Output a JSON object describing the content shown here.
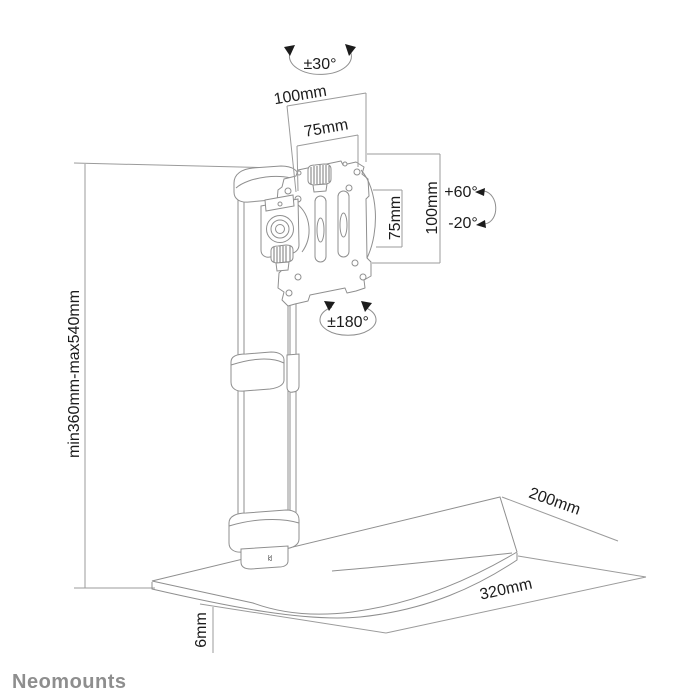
{
  "drawing": {
    "title_hint": "monitor desk stand technical drawing",
    "labels": {
      "swivel_top": "±30°",
      "vesa_width_outer": "100mm",
      "vesa_width_inner": "75mm",
      "vesa_height_inner": "75mm",
      "vesa_height_outer": "100mm",
      "tilt_up": "+60°",
      "tilt_down": "-20°",
      "rotation": "±180°",
      "height_range": "min360mm-max540mm",
      "base_depth": "200mm",
      "base_width": "320mm",
      "base_thickness": "6mm",
      "collar_marking": "32"
    },
    "colors": {
      "background": "#ffffff",
      "line": "#8f8f8f",
      "dim_line": "#9b9b9b",
      "text": "#1c1c1c",
      "brand": "#8e8e8e"
    }
  },
  "footer": {
    "brand": "Neomounts"
  }
}
